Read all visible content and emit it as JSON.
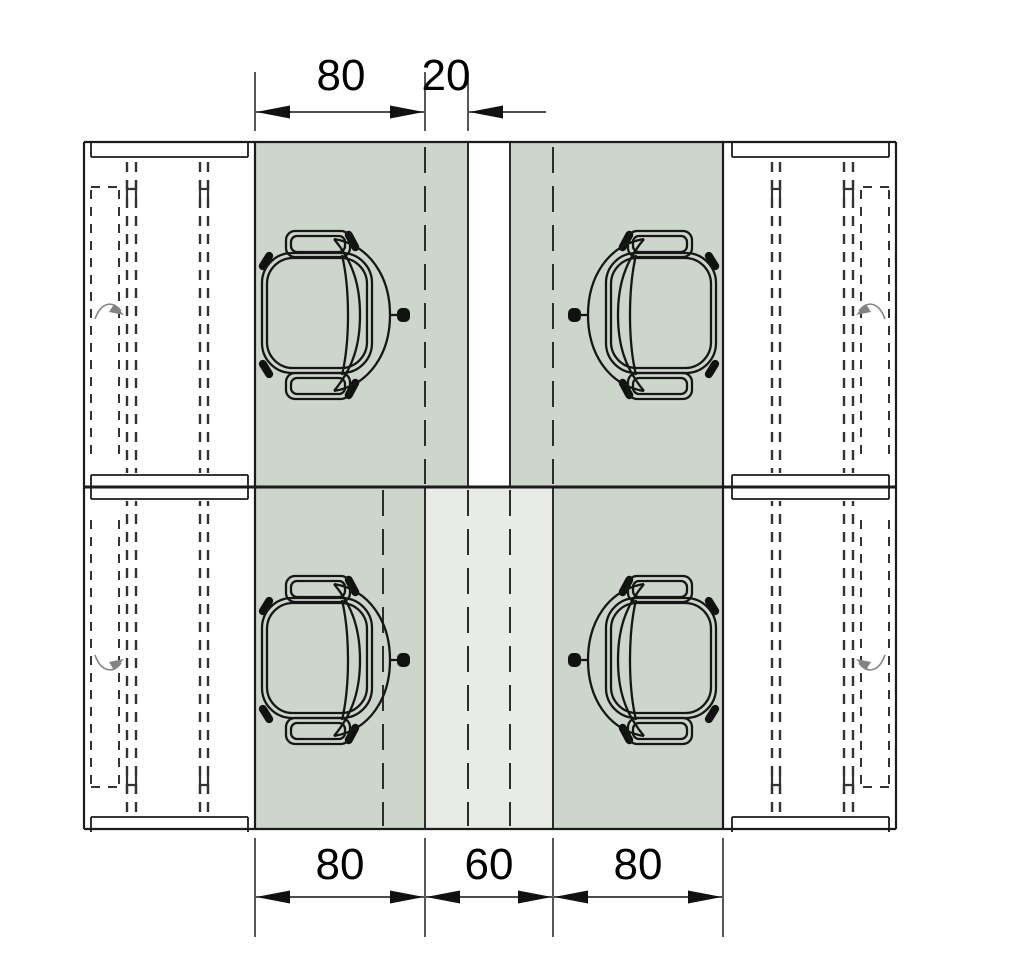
{
  "drawing": {
    "type": "office-desk-spacing-plan",
    "dimensions_top": [
      {
        "label": "80"
      },
      {
        "label": "20"
      }
    ],
    "dimensions_bottom": [
      {
        "label": "80"
      },
      {
        "label": "60"
      },
      {
        "label": "80"
      }
    ]
  },
  "icons": {
    "chair": "office-chair-plan-icon",
    "desk": "desk-plan-icon",
    "arc": "swivel-arc-icon"
  },
  "colors": {
    "clearance_zone": "#cdd6cb",
    "passage_zone": "#e8ebe6",
    "line": "#1b1b1b",
    "background": "#ffffff"
  }
}
